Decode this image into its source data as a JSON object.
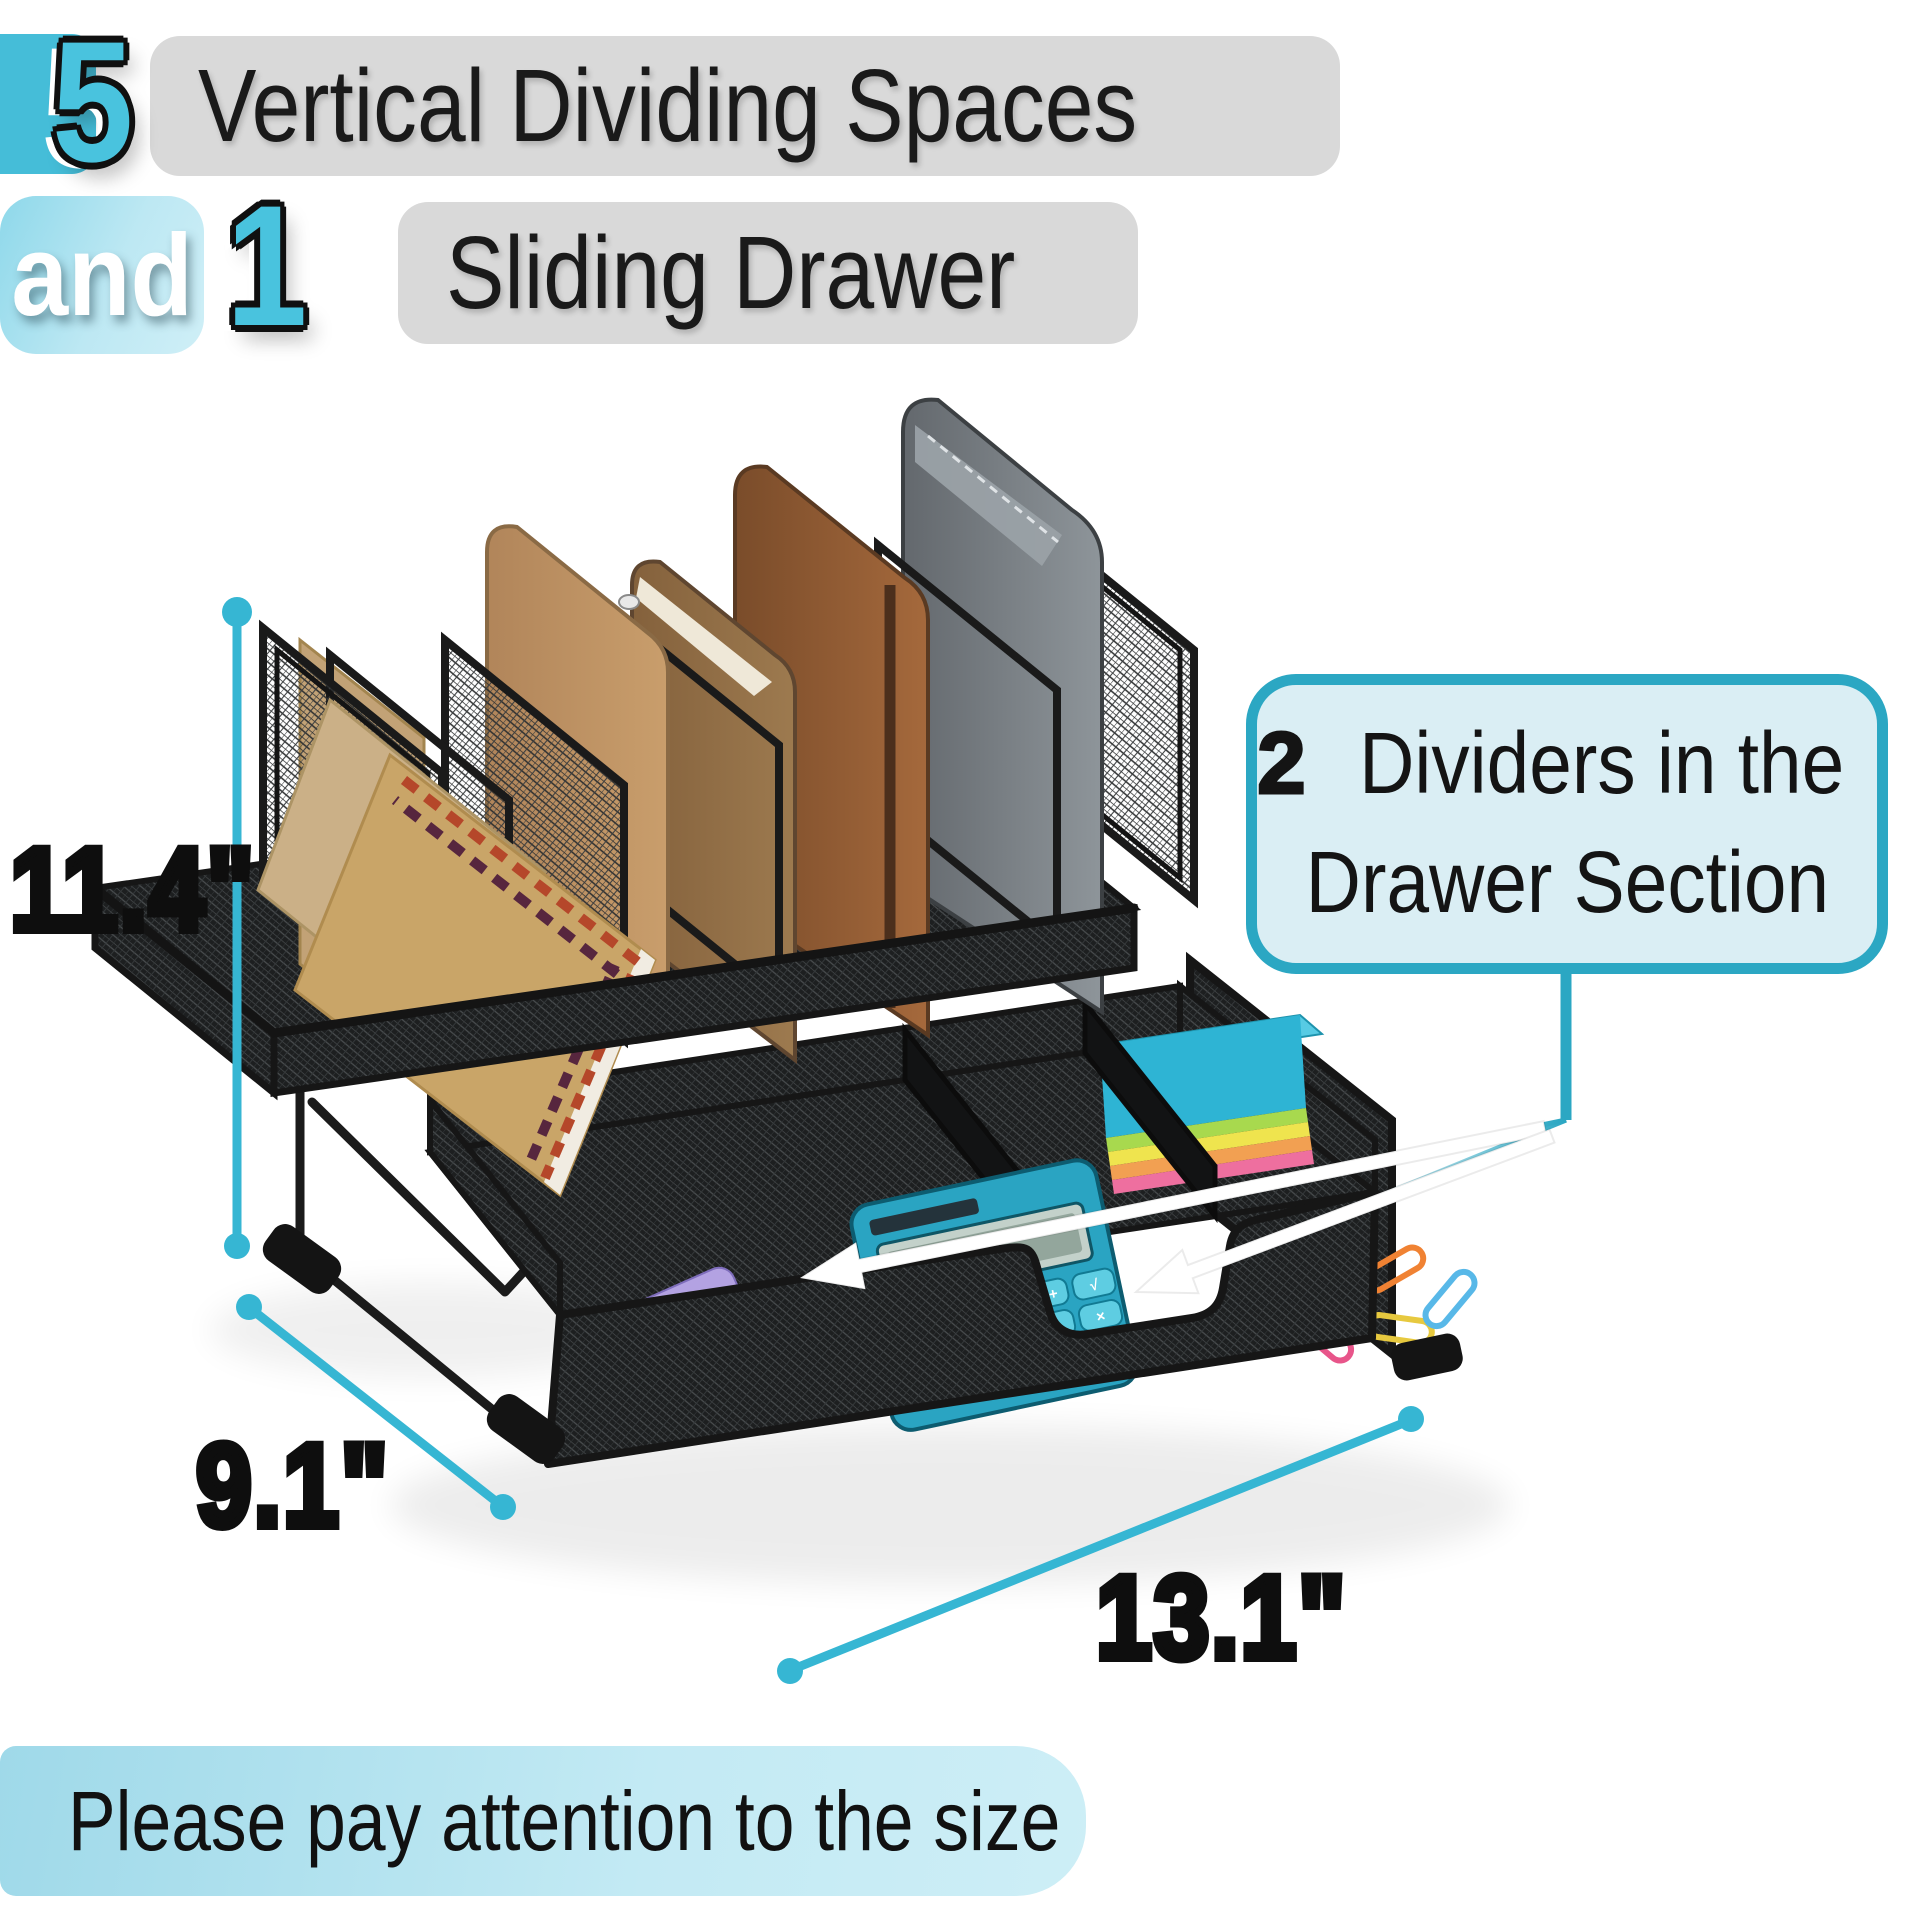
{
  "header": {
    "count_vertical": "5",
    "title_vertical": "Vertical Dividing Spaces",
    "conjunction": "and",
    "count_drawer": "1",
    "title_drawer": "Sliding Drawer"
  },
  "callout": {
    "number": "2",
    "line1": "Dividers in the",
    "line2": "Drawer Section"
  },
  "dimensions": {
    "height": "11.4\"",
    "depth": "9.1\"",
    "width": "13.1\""
  },
  "footer": {
    "note": "Please pay attention to the size",
    "icon": "attention-play-icon"
  },
  "calculator": {
    "keys": [
      "MR",
      "M-",
      "M+",
      "√",
      "▶",
      "÷",
      "9",
      "×",
      "8",
      "6",
      "5",
      "-"
    ]
  },
  "colors": {
    "accent": "#36b6d3",
    "accent_dark": "#2ba7c3",
    "numeral_fill": "#49c3de",
    "callout_fill": "#daeef4",
    "pill_gray": "#d9d9d9",
    "text_dark": "#141414",
    "banner_start": "#9fd9e9",
    "banner_end": "#cdeef6"
  }
}
